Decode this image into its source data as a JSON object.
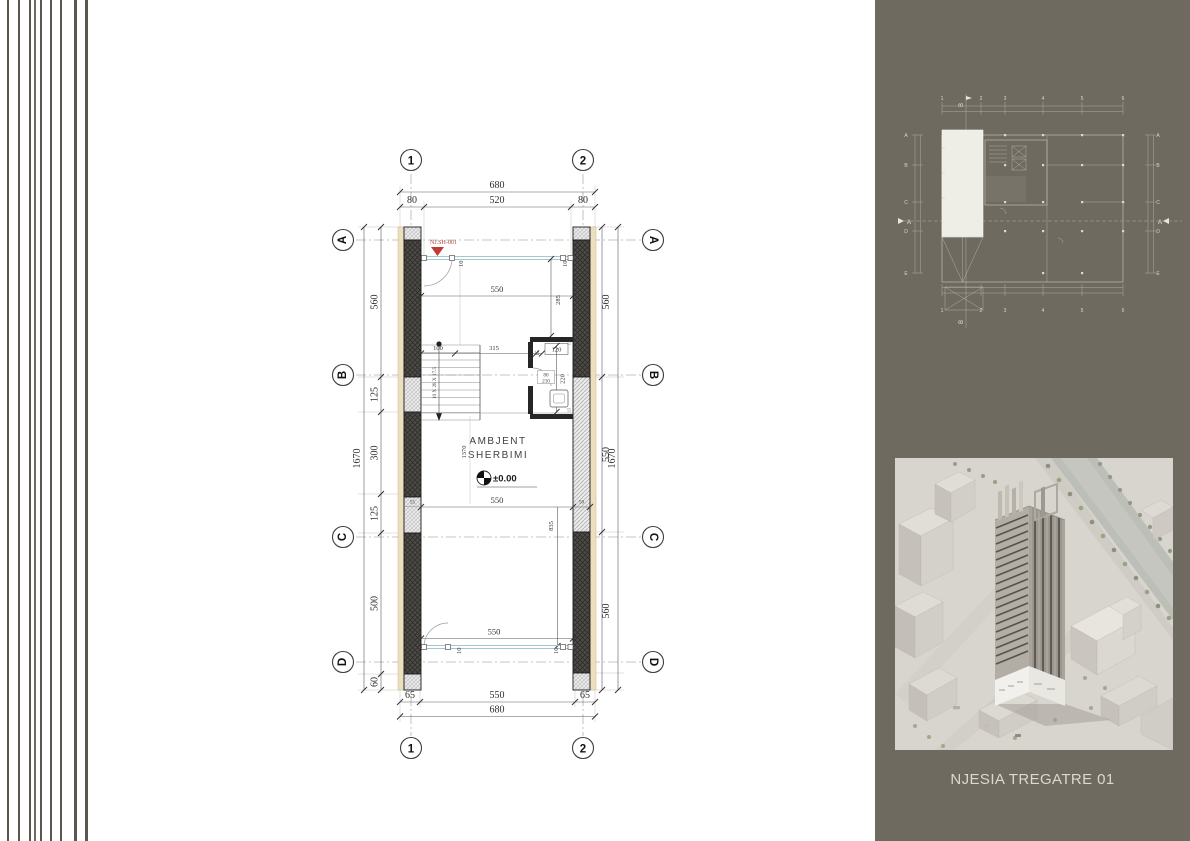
{
  "plan": {
    "grid_cols": [
      "1",
      "2"
    ],
    "grid_rows": [
      "A",
      "B",
      "C",
      "D"
    ],
    "unit_tag": "NJ.SH-001",
    "room_label": [
      "AMBJENT",
      "SHERBIMI"
    ],
    "level": "±0.00",
    "stair_note": "10 X 28 X 17.5",
    "dims": {
      "top_total": "680",
      "top_sub": [
        "80",
        "520",
        "80"
      ],
      "bottom_sub": [
        "65",
        "550",
        "65"
      ],
      "bottom_total": "680",
      "left_chain": [
        "560",
        "125",
        "300",
        "125",
        "500",
        "60"
      ],
      "left_total": "1670",
      "right_chain": [
        "560",
        "550",
        "560"
      ],
      "right_total": "1670",
      "glass_width_top": "550",
      "upper_height": "285",
      "stair_width": "100",
      "mid_span": "315",
      "thk_15": "15",
      "fixture_120": "120",
      "door_width": "80",
      "door_height": "210",
      "wc_height": "220",
      "room_height": "1370",
      "mid_width": "550",
      "wall_50": "50",
      "lower_height": "835",
      "seg_55": "55",
      "glass_width_bottom": "550",
      "glass_thk": "10"
    }
  },
  "keyplan": {
    "cols": [
      "1",
      "2",
      "3",
      "4",
      "5",
      "6"
    ],
    "rows": [
      "A",
      "B",
      "C",
      "D",
      "E"
    ],
    "section_label": "A",
    "flag_label": "B"
  },
  "render_caption": "NJESIA TREGATRE 01",
  "colors": {
    "panel_bg": "#6f6a60",
    "accent_red": "#b03a2e",
    "glass": "#a3c8ce",
    "insulation_tan": "#ecdfc0"
  }
}
